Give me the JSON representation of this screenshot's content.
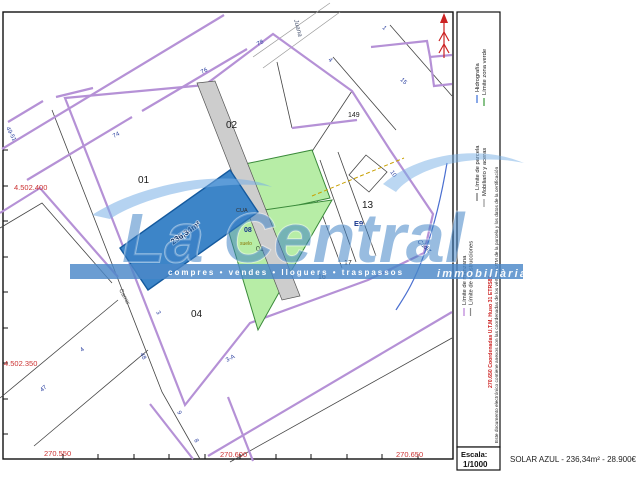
{
  "colors": {
    "solar_parcel": "#3d85c8",
    "solar_parcel_border": "#155a9e",
    "green_zone": "#b7eda6",
    "green_border": "#3a8a3a",
    "road_strip": "#cdcdcd",
    "manzana_line": "#b591d6",
    "watermark_bar": "#4a87c8",
    "watermark_text": "rgba(58,126,196,0.52)",
    "coordinate_red": "#cc3333",
    "hydrography_blue": "#4a6fd0",
    "north_arrow_red": "#cc2222"
  },
  "legend_samples": [
    {
      "x": 464,
      "y1": 308,
      "y2": 316,
      "c": "#b97fd8"
    },
    {
      "x": 470.5,
      "y1": 308,
      "y2": 316,
      "c": "#8a8a8a"
    },
    {
      "x": 477,
      "y1": 193,
      "y2": 201,
      "c": "#6e6e6e"
    },
    {
      "x": 477,
      "y1": 95,
      "y2": 103,
      "c": "#3a6fd8"
    },
    {
      "x": 484,
      "y1": 199,
      "y2": 207,
      "c": "#9a9a9a"
    },
    {
      "x": 484,
      "y1": 98,
      "y2": 106,
      "c": "#3a9a3a"
    }
  ],
  "text_layers": {
    "map": [
      {
        "n": "parcel-label-01",
        "t": "01",
        "x": 138,
        "y": 183,
        "s": 10
      },
      {
        "n": "parcel-label-02",
        "t": "02",
        "x": 226,
        "y": 128,
        "s": 10
      },
      {
        "n": "parcel-label-04",
        "t": "04",
        "x": 191,
        "y": 317,
        "s": 10
      },
      {
        "n": "parcel-label-13",
        "t": "13",
        "x": 362,
        "y": 208,
        "s": 10
      },
      {
        "n": "parcel-label-149",
        "t": "149",
        "x": 348,
        "y": 117,
        "s": 7
      },
      {
        "n": "parcel-label-16",
        "t": "16",
        "x": 318,
        "y": 279,
        "s": 7
      },
      {
        "n": "parcel-label-17",
        "t": "17",
        "x": 344,
        "y": 265,
        "s": 7
      },
      {
        "n": "parcel-label-e9",
        "t": "E9",
        "x": 354,
        "y": 226,
        "s": 7.5,
        "c": "#16348c",
        "w": "bold"
      },
      {
        "n": "parcel-label-08",
        "t": "08",
        "x": 244,
        "y": 232,
        "s": 7,
        "c": "#16348c",
        "w": "bold"
      },
      {
        "n": "parcel-label-01-green",
        "t": "01",
        "x": 256,
        "y": 251,
        "s": 7,
        "c": "#2d4a2d"
      },
      {
        "n": "map-label-cua",
        "t": "CUA",
        "x": 236,
        "y": 212,
        "s": 5.5,
        "c": "#333333"
      },
      {
        "n": "map-label-suelo",
        "t": "suelo",
        "x": 240,
        "y": 245,
        "s": 5,
        "c": "#8a7500"
      },
      {
        "n": "solar-area-label",
        "t": "236,34m²",
        "x": 187,
        "y": 235,
        "s": 8,
        "c": "#0b2e66",
        "rot": -35,
        "a": "middle",
        "w": "bold",
        "cl": "halo"
      },
      {
        "n": "street-number-76",
        "t": "76",
        "x": 202,
        "y": 74,
        "s": 6,
        "c": "#2a3f9f",
        "rot": -28
      },
      {
        "n": "street-number-74",
        "t": "74",
        "x": 114,
        "y": 138,
        "s": 6,
        "c": "#2a3f9f",
        "rot": -28
      },
      {
        "n": "street-number-78",
        "t": "78",
        "x": 258,
        "y": 46,
        "s": 6,
        "c": "#2a3f9f",
        "rot": -28
      },
      {
        "n": "street-number-49-51",
        "t": "49-51",
        "x": 6,
        "y": 128,
        "s": 6,
        "c": "#2a3f9f",
        "rot": 62
      },
      {
        "n": "street-number-48",
        "t": "48",
        "x": 140,
        "y": 354,
        "s": 6,
        "c": "#2a3f9f",
        "rot": 62
      },
      {
        "n": "street-number-3",
        "t": "3",
        "x": 156,
        "y": 312,
        "s": 6,
        "c": "#2a3f9f",
        "rot": 62
      },
      {
        "n": "street-number-9",
        "t": "9",
        "x": 177,
        "y": 412,
        "s": 6,
        "c": "#2a3f9f",
        "rot": 62
      },
      {
        "n": "street-number-8",
        "t": "8",
        "x": 194,
        "y": 440,
        "s": 6,
        "c": "#2a3f9f",
        "rot": 62
      },
      {
        "n": "street-number-47",
        "t": "47",
        "x": 42,
        "y": 392,
        "s": 6,
        "c": "#2a3f9f",
        "rot": -40
      },
      {
        "n": "street-number-4",
        "t": "4",
        "x": 82,
        "y": 352,
        "s": 6,
        "c": "#2a3f9f",
        "rot": -40
      },
      {
        "n": "street-number-3a",
        "t": "3-A",
        "x": 227,
        "y": 362,
        "s": 6,
        "c": "#2a3f9f",
        "rot": -28
      },
      {
        "n": "street-number-10",
        "t": "10",
        "x": 390,
        "y": 172,
        "s": 6,
        "c": "#2a3f9f",
        "rot": 55
      },
      {
        "n": "street-number-4b",
        "t": "4",
        "x": 328,
        "y": 60,
        "s": 6,
        "c": "#2a3f9f",
        "rot": 45
      },
      {
        "n": "street-number-1",
        "t": "1",
        "x": 382,
        "y": 28,
        "s": 6,
        "c": "#2a3f9f",
        "rot": 45
      },
      {
        "n": "street-number-15",
        "t": "15",
        "x": 400,
        "y": 80,
        "s": 6,
        "c": "#2a3f9f",
        "rot": 45
      },
      {
        "n": "street-name-juana",
        "t": "Juana",
        "x": 294,
        "y": 20,
        "s": 6.5,
        "c": "#55607a",
        "rot": 75,
        "i": 1
      },
      {
        "n": "street-name-carrer",
        "t": "Carrer",
        "x": 119,
        "y": 290,
        "s": 6,
        "c": "#555555",
        "rot": 62
      },
      {
        "n": "street-name-cadiz",
        "t": "Cádiz",
        "x": 417,
        "y": 242,
        "s": 6.5,
        "c": "#1a3a8a",
        "rot": 42,
        "i": 1
      },
      {
        "n": "coord-label-y-top",
        "t": "4.502.400",
        "x": 14,
        "y": 190,
        "s": 7.5,
        "c": "#cc3333"
      },
      {
        "n": "coord-label-y-mid",
        "t": "4.502.350",
        "x": 4,
        "y": 366,
        "s": 7.5,
        "c": "#cc3333"
      },
      {
        "n": "coord-label-x-270550",
        "t": "270.550",
        "x": 44,
        "y": 456,
        "s": 7.5,
        "c": "#cc3333"
      },
      {
        "n": "coord-label-x-270600",
        "t": "270.600",
        "x": 220,
        "y": 457,
        "s": 7.5,
        "c": "#cc3333"
      },
      {
        "n": "coord-label-x-270650",
        "t": "270.650",
        "x": 396,
        "y": 457,
        "s": 7.5,
        "c": "#cc3333"
      }
    ],
    "sidebar": [
      {
        "n": "legend-limite-manzana",
        "t": "Límite de manzana",
        "x": 466,
        "y": 305,
        "s": 5.8,
        "c": "#222222",
        "rot": -90
      },
      {
        "n": "legend-limite-construcciones",
        "t": "Límite de construcciones",
        "x": 472.5,
        "y": 305,
        "s": 5.8,
        "c": "#222222",
        "rot": -90
      },
      {
        "n": "legend-limite-parcela",
        "t": "Límite de parcela",
        "x": 479,
        "y": 190,
        "s": 5.8,
        "c": "#222222",
        "rot": -90
      },
      {
        "n": "legend-hidrografia",
        "t": "Hidrografía",
        "x": 479,
        "y": 92,
        "s": 5.8,
        "c": "#222222",
        "rot": -90
      },
      {
        "n": "legend-mobiliario-aceras",
        "t": "Mobiliario y aceras",
        "x": 486,
        "y": 196,
        "s": 5.8,
        "c": "#222222",
        "rot": -90
      },
      {
        "n": "legend-limite-zona-verde",
        "t": "Límite zona verde",
        "x": 486,
        "y": 95,
        "s": 5.8,
        "c": "#222222",
        "rot": -90
      },
      {
        "n": "sidebar-coordinates-note",
        "t": "270.650  Coordenadas U.T.M. Huso 31 ETRS89",
        "x": 492,
        "y": 388,
        "s": 5.2,
        "c": "#cc2222",
        "w": "bold",
        "rot": -90
      },
      {
        "n": "sidebar-disclaimer",
        "t": "Este documento electrónico contiene anexos con las coordenadas de los vértices UTM de la parcela y los datos de la certificación",
        "x": 498,
        "y": 443,
        "s": 4.8,
        "c": "#222222",
        "rot": -90
      }
    ],
    "footer": [
      {
        "n": "scale-label",
        "t": "Escala:",
        "x": 461,
        "y": 457,
        "s": 7.5,
        "c": "#111111",
        "w": "bold"
      },
      {
        "n": "scale-value",
        "t": "1/1000",
        "x": 463,
        "y": 467,
        "s": 8,
        "c": "#111111",
        "w": "bold"
      },
      {
        "n": "listing-summary",
        "t": "SOLAR AZUL - 236,34m² - 28.900€",
        "x": 510,
        "y": 462,
        "s": 8,
        "c": "#222222"
      }
    ],
    "watermark": [
      {
        "n": "watermark-brand",
        "t": "La Central",
        "x": 122,
        "y": 262,
        "s": 70,
        "c": "rgba(58,126,196,0.52)",
        "w": "bold",
        "i": 1,
        "cl": "halo-big"
      },
      {
        "n": "watermark-tagline",
        "t": "compres • vendes • lloguers • traspassos",
        "x": 168,
        "y": 275,
        "s": 8,
        "c": "#ffffff",
        "w": "bold",
        "ls": 2
      },
      {
        "n": "watermark-immobiliaria",
        "t": "immobiliària",
        "x": 437,
        "y": 277,
        "s": 11,
        "c": "rgba(255,255,255,0.95)",
        "w": "bold",
        "i": 1,
        "ls": 2.2
      }
    ]
  }
}
